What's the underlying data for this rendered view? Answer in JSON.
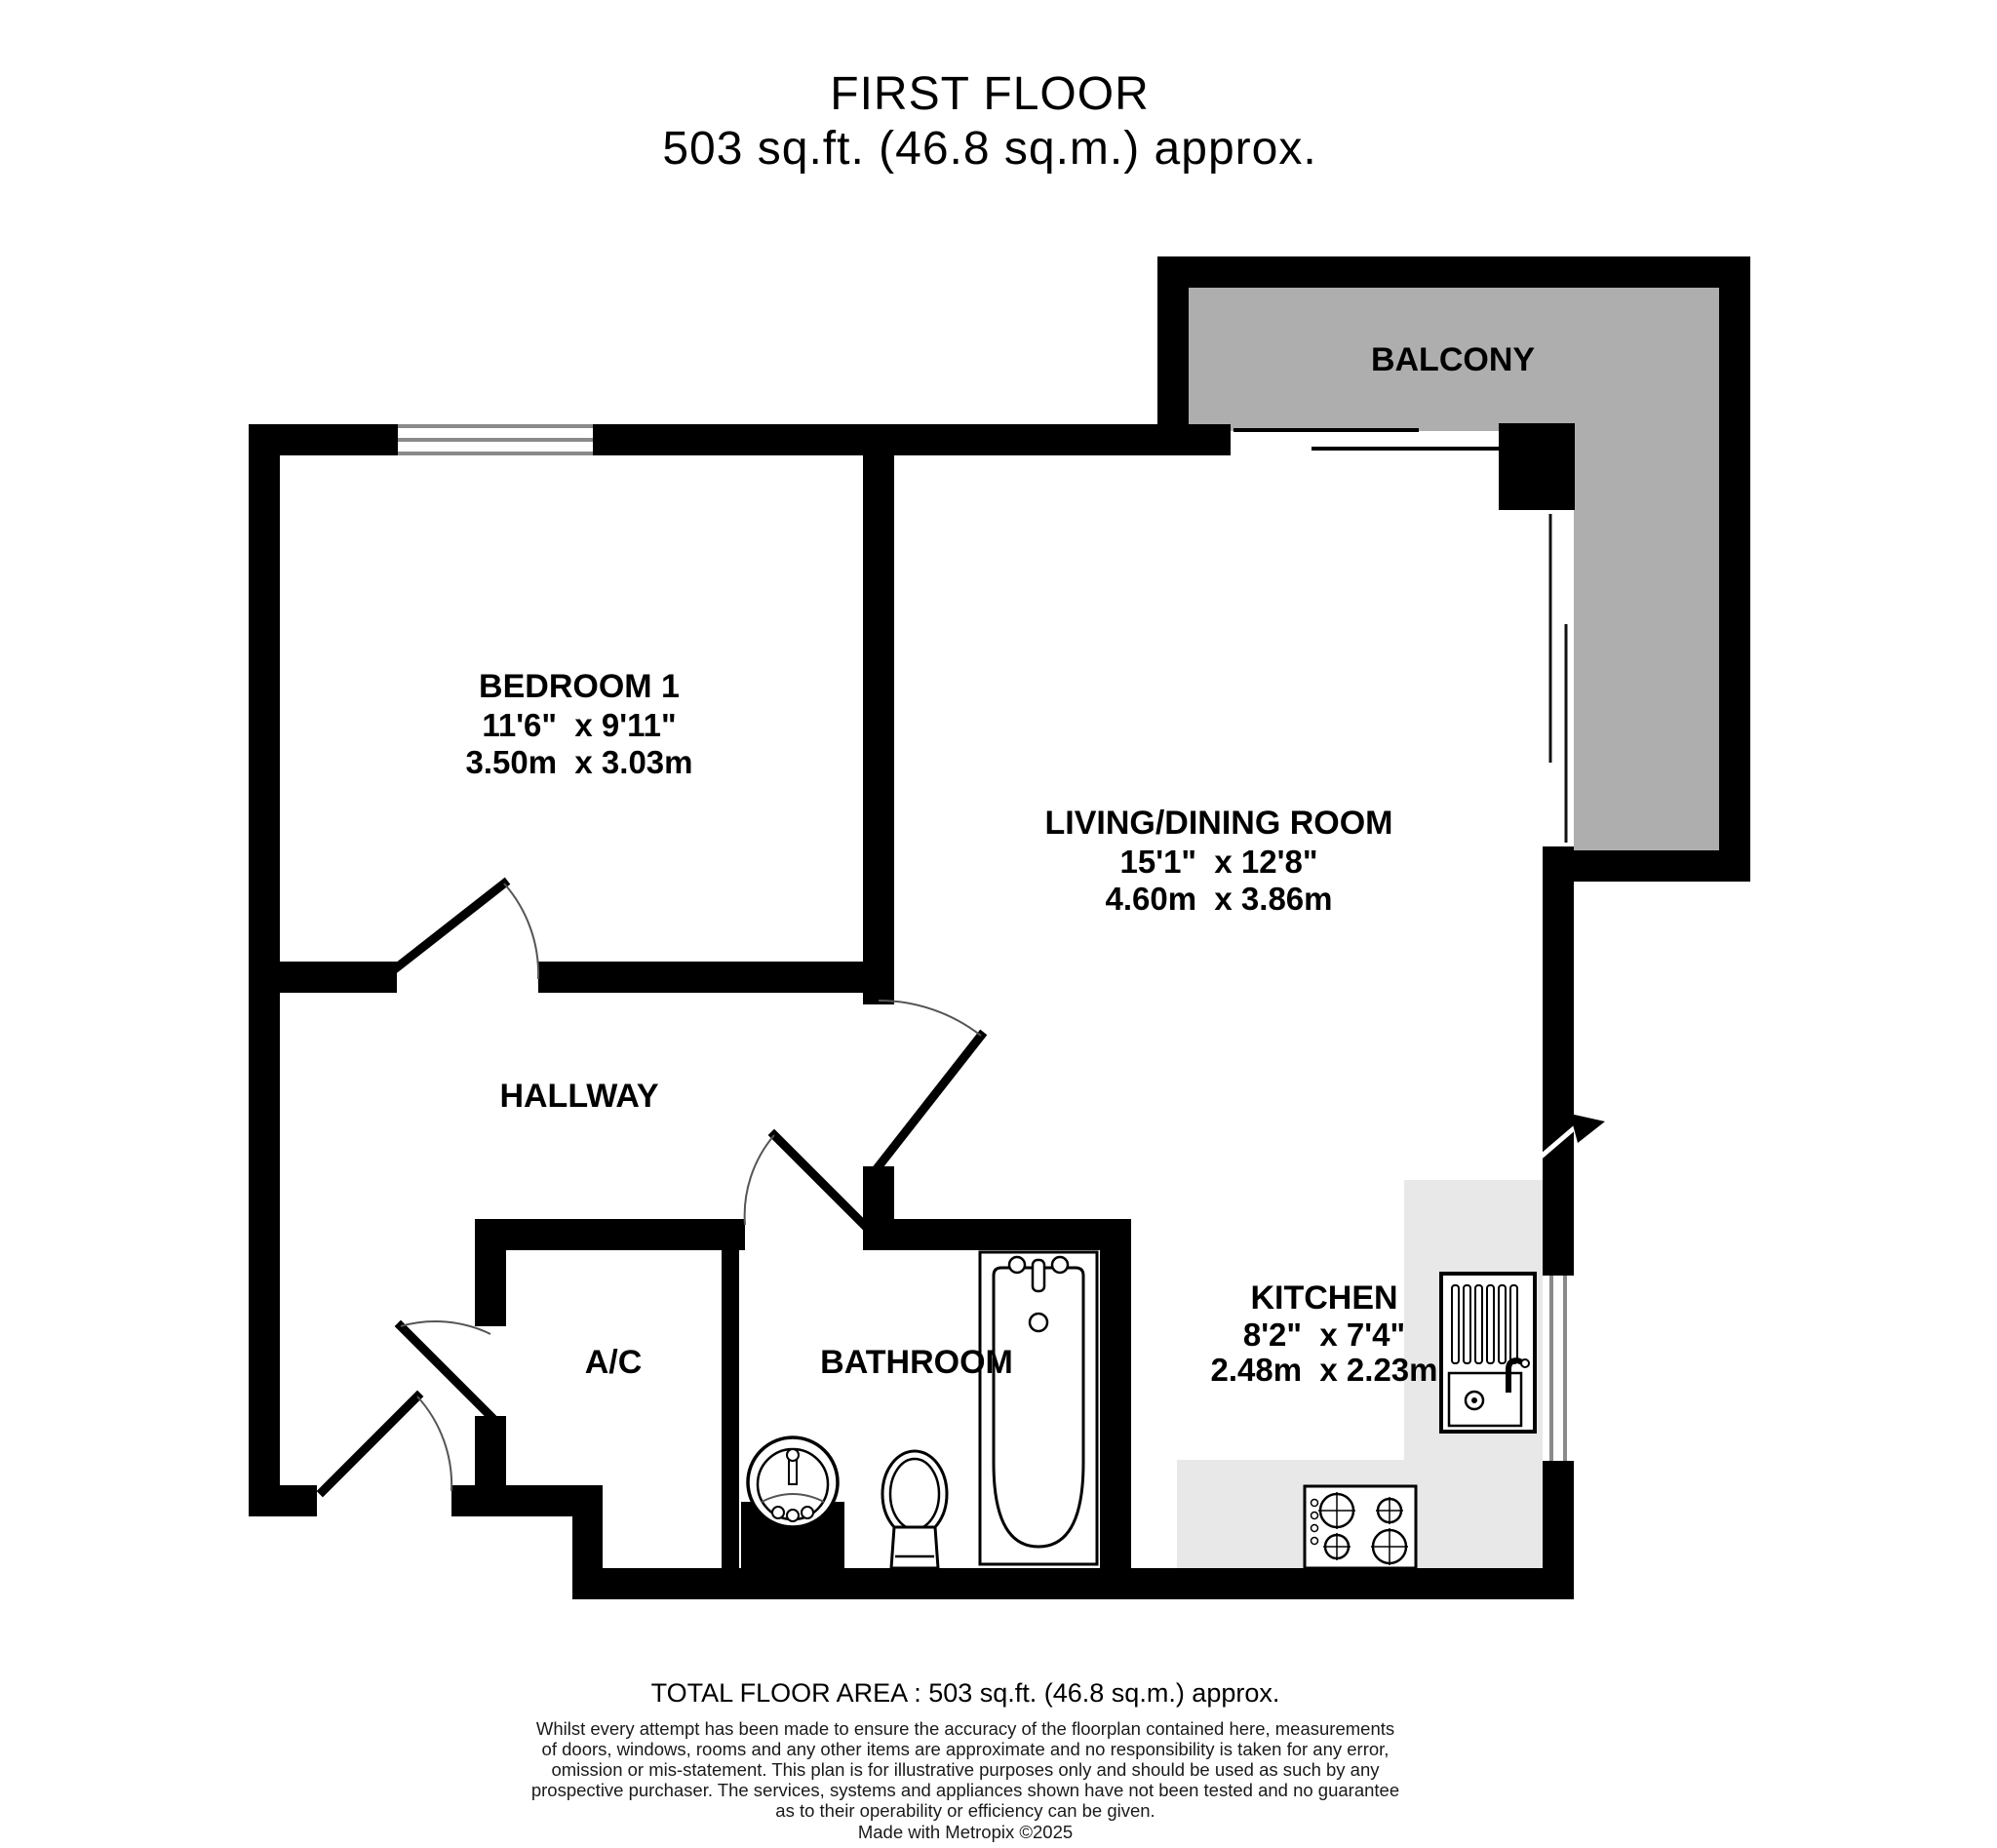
{
  "title": {
    "line1": "FIRST FLOOR",
    "line2": "503 sq.ft. (46.8 sq.m.) approx."
  },
  "rooms": {
    "balcony": {
      "name": "BALCONY"
    },
    "bedroom": {
      "name": "BEDROOM 1",
      "imperial": "11'6\"  x 9'11\"",
      "metric": "3.50m  x 3.03m"
    },
    "living": {
      "name": "LIVING/DINING ROOM",
      "imperial": "15'1\"  x 12'8\"",
      "metric": "4.60m  x 3.86m"
    },
    "hallway": {
      "name": "HALLWAY"
    },
    "ac": {
      "name": "A/C"
    },
    "bathroom": {
      "name": "BATHROOM"
    },
    "kitchen": {
      "name": "KITCHEN",
      "imperial": "8'2\"  x 7'4\"",
      "metric": "2.48m  x 2.23m"
    }
  },
  "footer": {
    "total": "TOTAL FLOOR AREA : 503 sq.ft. (46.8 sq.m.) approx.",
    "disclaimer_lines": [
      "Whilst every attempt has been made to ensure the accuracy of the floorplan contained here, measurements",
      "of doors, windows, rooms and any other items are approximate and no responsibility is taken for any error,",
      "omission or mis-statement. This plan is for illustrative purposes only and should be used as such by any",
      "prospective purchaser. The services, systems and appliances shown have not been tested and no guarantee",
      "as to their operability or efficiency can be given."
    ],
    "credit": "Made with Metropix ©2025"
  },
  "colors": {
    "wall": "#000000",
    "balcony_fill": "#aeaeae",
    "counter_fill": "#e8e8e8",
    "window_line": "#8a8a8a"
  }
}
